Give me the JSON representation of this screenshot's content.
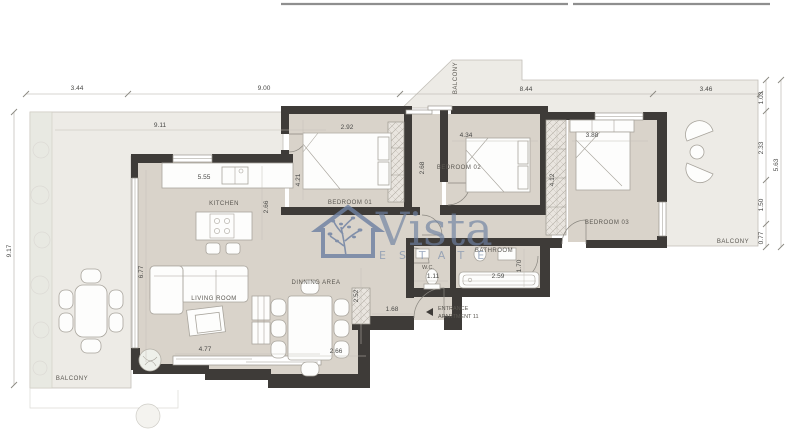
{
  "watermark": {
    "brand": "Vista",
    "subtitle": "ESTATE",
    "color": "#6e81a2"
  },
  "rooms": {
    "kitchen": "KITCHEN",
    "living_room": "LIVING ROOM",
    "dining_area": "DINNING AREA",
    "bedroom_01": "BEDROOM 01",
    "bedroom_02": "BEDROOM 02",
    "bedroom_03": "BEDROOM 03",
    "bathroom": "BATHROOM",
    "wc": "W.C.",
    "balcony_left": "BALCONY",
    "balcony_top": "BALCONY",
    "balcony_right": "BALCONY"
  },
  "entrance": {
    "line1": "ENTRANCE",
    "line2": "APARTMENT 11"
  },
  "dimensions": {
    "top_chain": [
      "3.44",
      "9.00",
      "8.44",
      "3.46"
    ],
    "left_total": "9.17",
    "right_chain": [
      "1.03",
      "2.33",
      "1.50",
      "0.77"
    ],
    "right_total": "5.63",
    "interior": {
      "terrace_width": "9.11",
      "kitchen_counter": "5.55",
      "kitchen_depth": "2.66",
      "living_length": "6.77",
      "living_window": "4.77",
      "dining_width": "2.66",
      "dining_depth": "2.52",
      "bedroom1_width": "2.92",
      "bedroom1_length": "4.21",
      "corridor_length": "2.68",
      "bedroom2_width": "4.34",
      "bedroom3_width": "3.88",
      "wardrobe_length": "4.12",
      "bathroom_width": "2.59",
      "bathroom_depth": "1.70",
      "wc_width": "1.11",
      "hall_width": "1.68"
    }
  },
  "colors": {
    "wall": "#3e3b38",
    "floor": "#d9d3ca",
    "terrace": "#edebe6",
    "watermark": "#6e81a2"
  }
}
